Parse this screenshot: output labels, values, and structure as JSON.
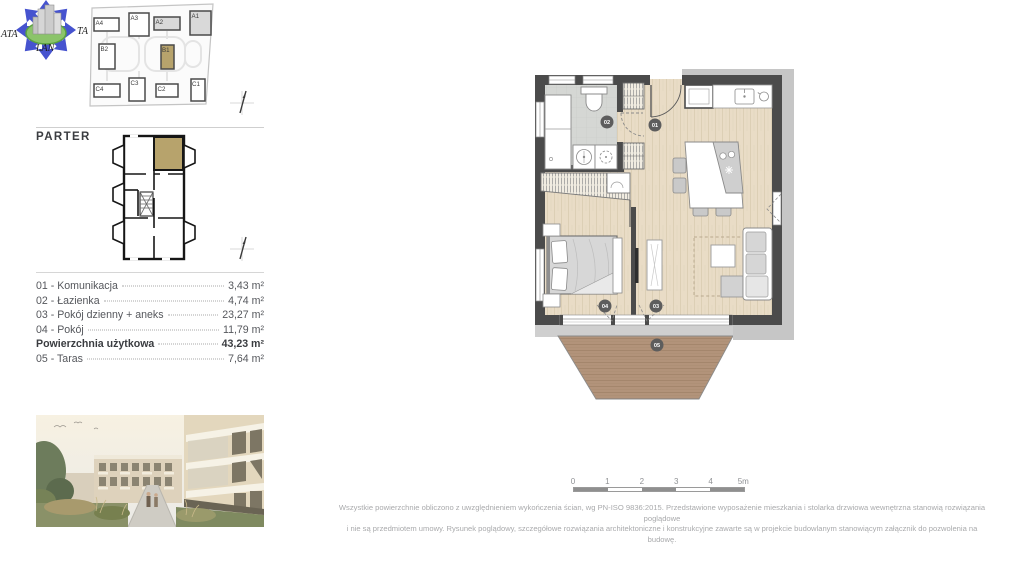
{
  "logo": {
    "left_text": "ATA",
    "right_text": "TA",
    "bottom_text": "LAN"
  },
  "site_plan": {
    "units": [
      "A4",
      "A3",
      "A2",
      "A1",
      "B2",
      "B1",
      "C4",
      "C3",
      "C2",
      "C1"
    ],
    "highlighted_unit": "B1"
  },
  "floor_label": "PARTER",
  "room_list": {
    "rows": [
      {
        "label": "01 - Komunikacja",
        "value": "3,43 m²"
      },
      {
        "label": "02 - Łazienka",
        "value": "4,74 m²"
      },
      {
        "label": "03 - Pokój dzienny + aneks",
        "value": "23,27 m²"
      },
      {
        "label": "04 - Pokój",
        "value": "11,79 m²"
      },
      {
        "label": "Powierzchnia użytkowa",
        "value": "43,23 m²"
      },
      {
        "label": "05 - Taras",
        "value": "7,64 m²"
      }
    ]
  },
  "main_plan": {
    "labels": {
      "hallway": "01",
      "bathroom": "02",
      "living_room": "03",
      "bedroom": "04",
      "terrace": "05"
    }
  },
  "scale_bar": {
    "ticks": [
      "0",
      "1",
      "2",
      "3",
      "4",
      "5m"
    ]
  },
  "disclaimer": {
    "line1": "Wszystkie powierzchnie obliczono z uwzględnieniem wykończenia ścian, wg PN-ISO 9836:2015. Przedstawione wyposażenie mieszkania i stolarka drzwiowa wewnętrzna stanowią rozwiązania poglądowe",
    "line2": "i nie są przedmiotem umowy. Rysunek poglądowy, szczegółowe rozwiązania architektoniczne i konstrukcyjne zawarte są w projekcie budowlanym stanowiącym załącznik do pozwolenia na budowę."
  },
  "colors": {
    "accent_tan": "#b7a36c",
    "wall_dark": "#4b4b4b",
    "wall_light": "#c6c6c6",
    "floor_wood": "#e9dcc6",
    "terrace_wood": "#b2937a",
    "bath_tile": "#d5d7d4",
    "text_gray": "#55575c",
    "muted_gray": "#a9aaac",
    "logo_blue": "#4653cf",
    "logo_green": "#8bc46a"
  }
}
